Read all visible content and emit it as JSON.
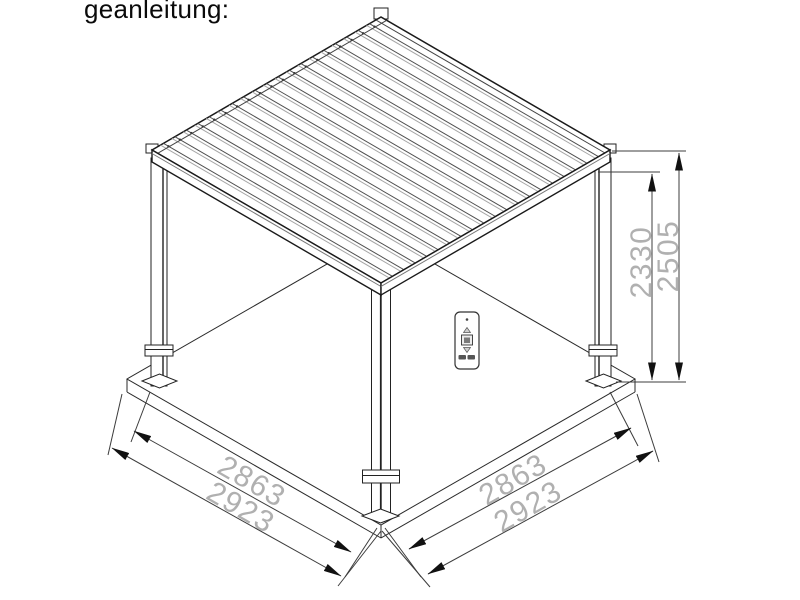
{
  "page": {
    "title": "geanleitung:"
  },
  "diagram": {
    "name": "pergola-isometric-assembly-drawing",
    "colors": {
      "outline": "#1f1f1f",
      "dim_line": "#3c3c3c",
      "dim_text": "#b0b0b0",
      "background": "#ffffff"
    },
    "dimensions": {
      "left_inner": "2863",
      "left_outer": "2923",
      "right_inner": "2863",
      "right_outer": "2923",
      "height_to_underside": "2330",
      "height_overall": "2505"
    },
    "parts": {
      "roof": "louvered-roof",
      "posts": [
        "post-left",
        "post-front",
        "post-right",
        "post-back"
      ],
      "ground": "ground-slab",
      "remote": "remote-control"
    }
  }
}
